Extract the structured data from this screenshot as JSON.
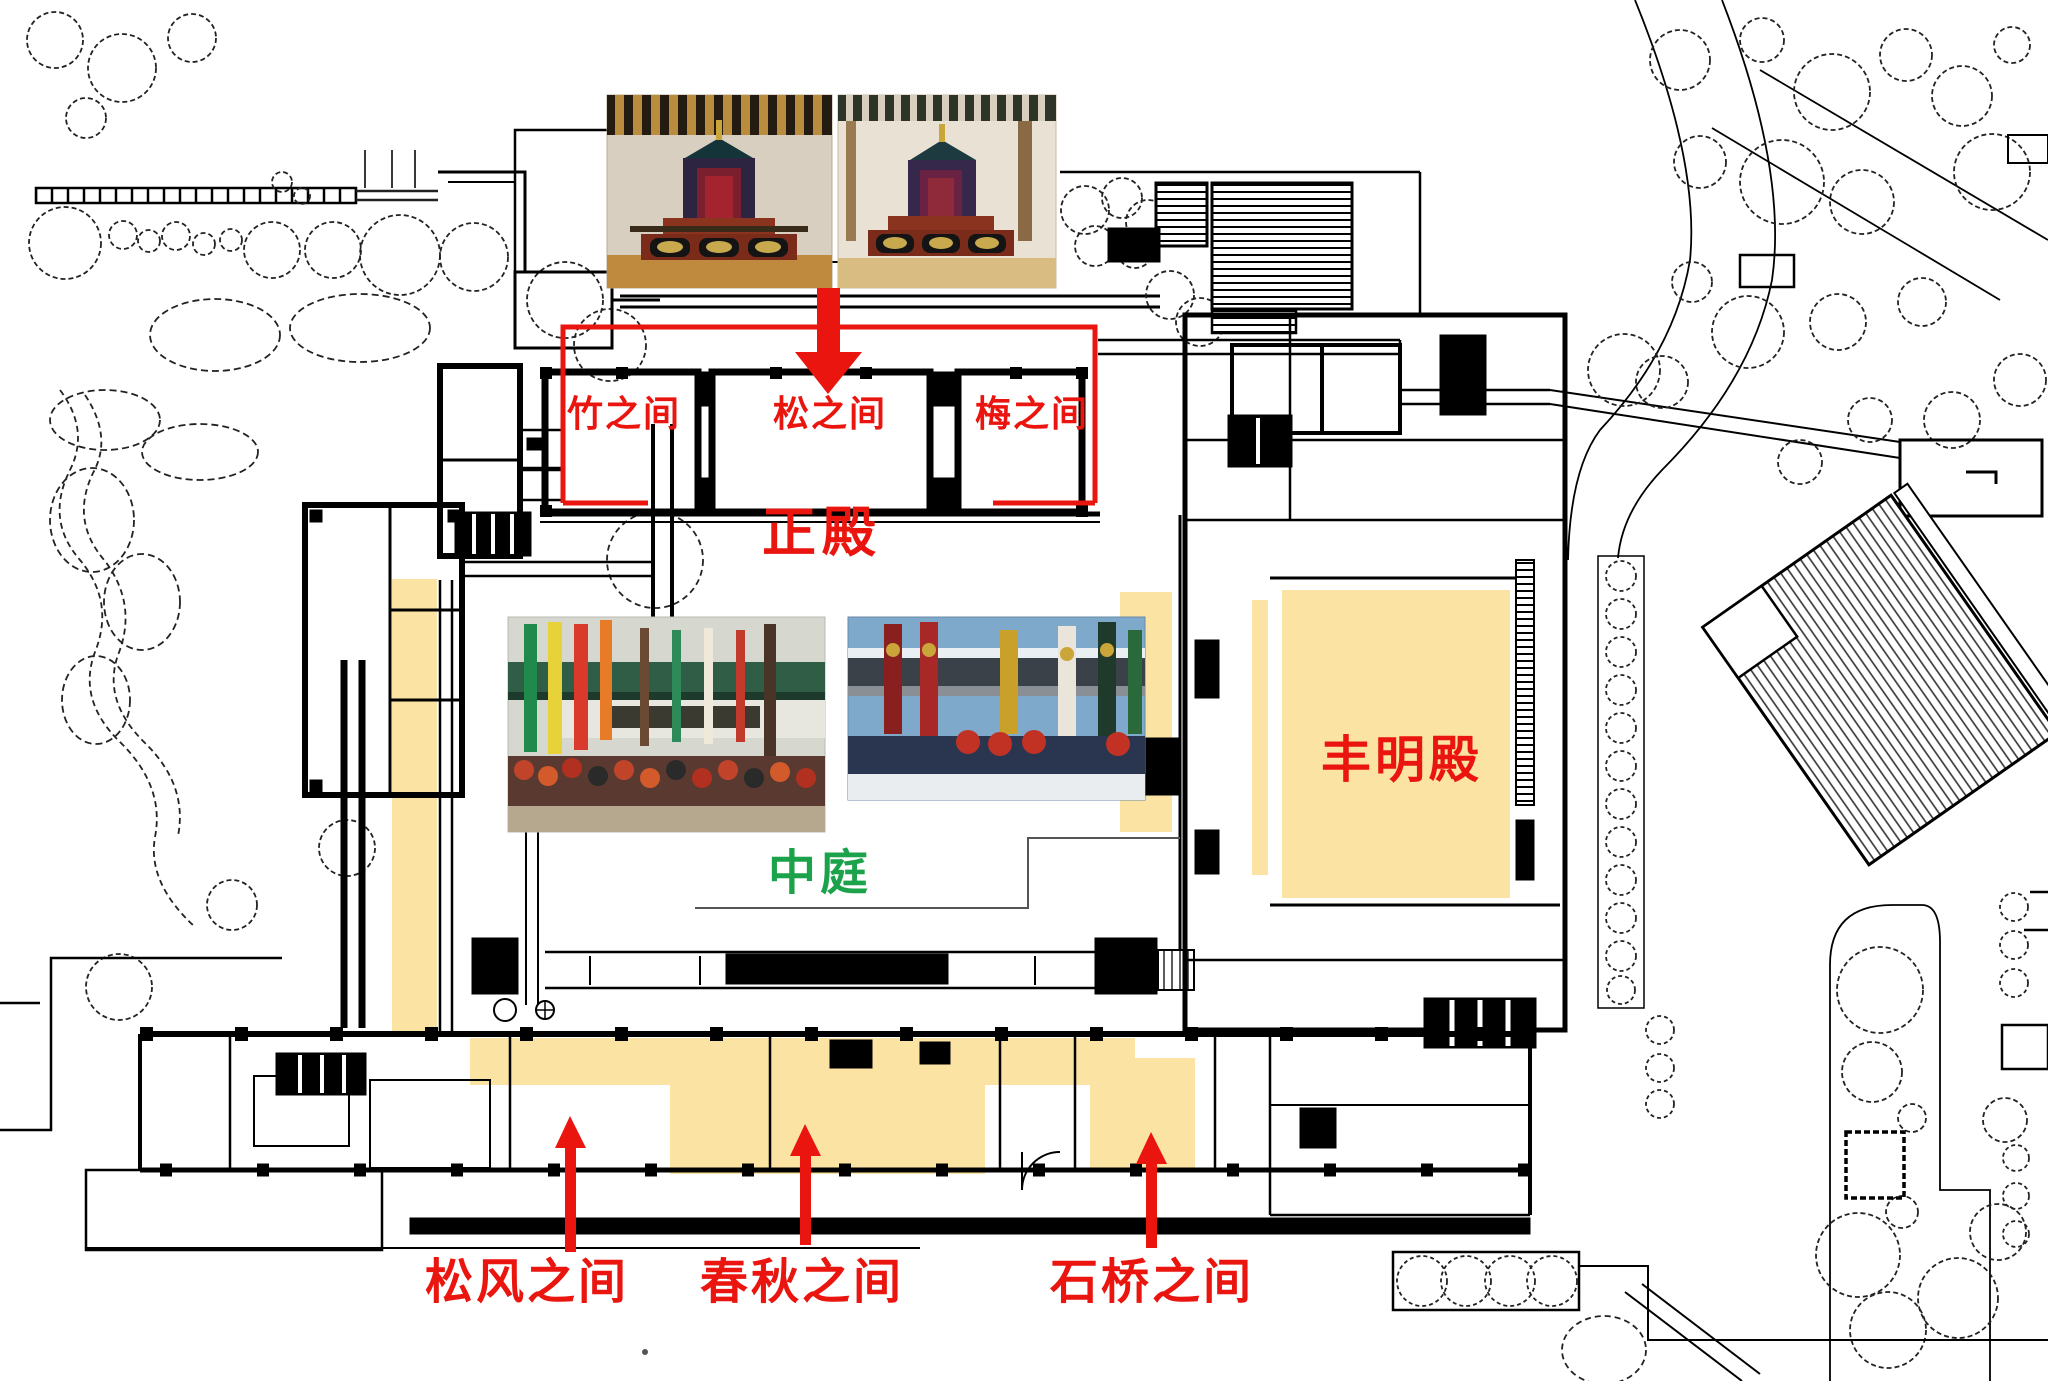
{
  "annotations": {
    "main_hall_rooms": [
      {
        "label": "竹之间"
      },
      {
        "label": "松之间"
      },
      {
        "label": "梅之间"
      }
    ],
    "main_hall": {
      "label": "正殿"
    },
    "courtyard": {
      "label": "中庭"
    },
    "homeiden": {
      "label": "丰明殿"
    },
    "south_rooms": [
      {
        "label": "松风之间"
      },
      {
        "label": "春秋之间"
      },
      {
        "label": "石桥之间"
      }
    ]
  },
  "photos": [
    {
      "name": "photo-throne-room-1",
      "alt": "Throne hall interior with canopied throne"
    },
    {
      "name": "photo-throne-room-2",
      "alt": "Throne hall interior, second view"
    },
    {
      "name": "photo-banner-ceremony-1",
      "alt": "Courtyard ceremony with colorful banner streamers"
    },
    {
      "name": "photo-banner-ceremony-2",
      "alt": "Courtyard ceremony with tall banners in snow"
    }
  ],
  "colors": {
    "annotation_red": "#e9150e",
    "courtyard_green": "#1ca24a",
    "highlight_yellow": "#fbe3a4",
    "plan_line": "#000000"
  }
}
